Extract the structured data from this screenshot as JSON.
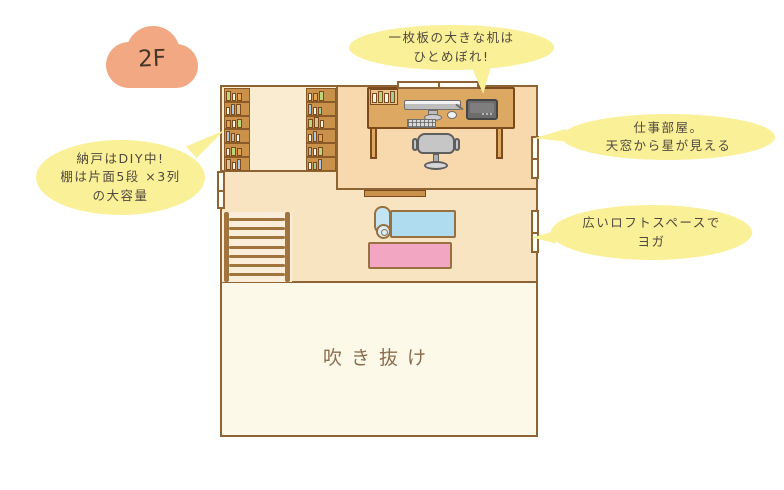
{
  "floor_label": "2F",
  "bubbles": {
    "desk": {
      "line1": "一枚板の大きな机は",
      "line2": "ひとめぼれ!"
    },
    "workroom": {
      "line1": "仕事部屋。",
      "line2": "天窓から星が見える"
    },
    "closet": {
      "line1": "納戸はDIY中!",
      "line2": "棚は片面5段 ×3列",
      "line3": "の大容量"
    },
    "loft": {
      "line1": "広いロフトスペースで",
      "line2": "ヨガ"
    }
  },
  "rooms": {
    "atrium_label": "吹き抜け"
  },
  "colors": {
    "wall": "#8F6434",
    "workroom_floor": "#F8D9AE",
    "closet_floor": "#FAECD0",
    "loft_floor": "#F9E4C2",
    "atrium_floor": "#FDF9E8",
    "stairs_floor": "#FAEEDA",
    "desk_wood": "#DCA862",
    "shelf_wood": "#C9914A",
    "bubble_yellow": "#FAF098",
    "cloud_salmon": "#F2A882",
    "yoga_mat_blue": "#AFDCEE",
    "rug_pink": "#F2A6C1"
  },
  "illustration": {
    "stairs_rung_count": 7,
    "book_palette": [
      "#F7F4EA",
      "#BCD47E",
      "#A9C9E4",
      "#E3A24C",
      "#C2BBA8",
      "#D9C18A",
      "#9FCE9A"
    ],
    "left_shelf_rows": [
      [
        1,
        0,
        3
      ],
      [
        0,
        2,
        5
      ],
      [
        3,
        0,
        1
      ],
      [
        2,
        4,
        0
      ],
      [
        0,
        1,
        3
      ],
      [
        5,
        0,
        2
      ]
    ],
    "right_shelf_rows": [
      [
        0,
        3,
        1
      ],
      [
        2,
        0,
        6
      ],
      [
        1,
        5,
        0
      ],
      [
        0,
        2,
        3
      ],
      [
        4,
        0,
        1
      ],
      [
        0,
        6,
        2
      ]
    ],
    "desk_book_colors": [
      "#F7F4EA",
      "#BCD47E",
      "#F7F4EA",
      "#9FCE9A"
    ]
  }
}
